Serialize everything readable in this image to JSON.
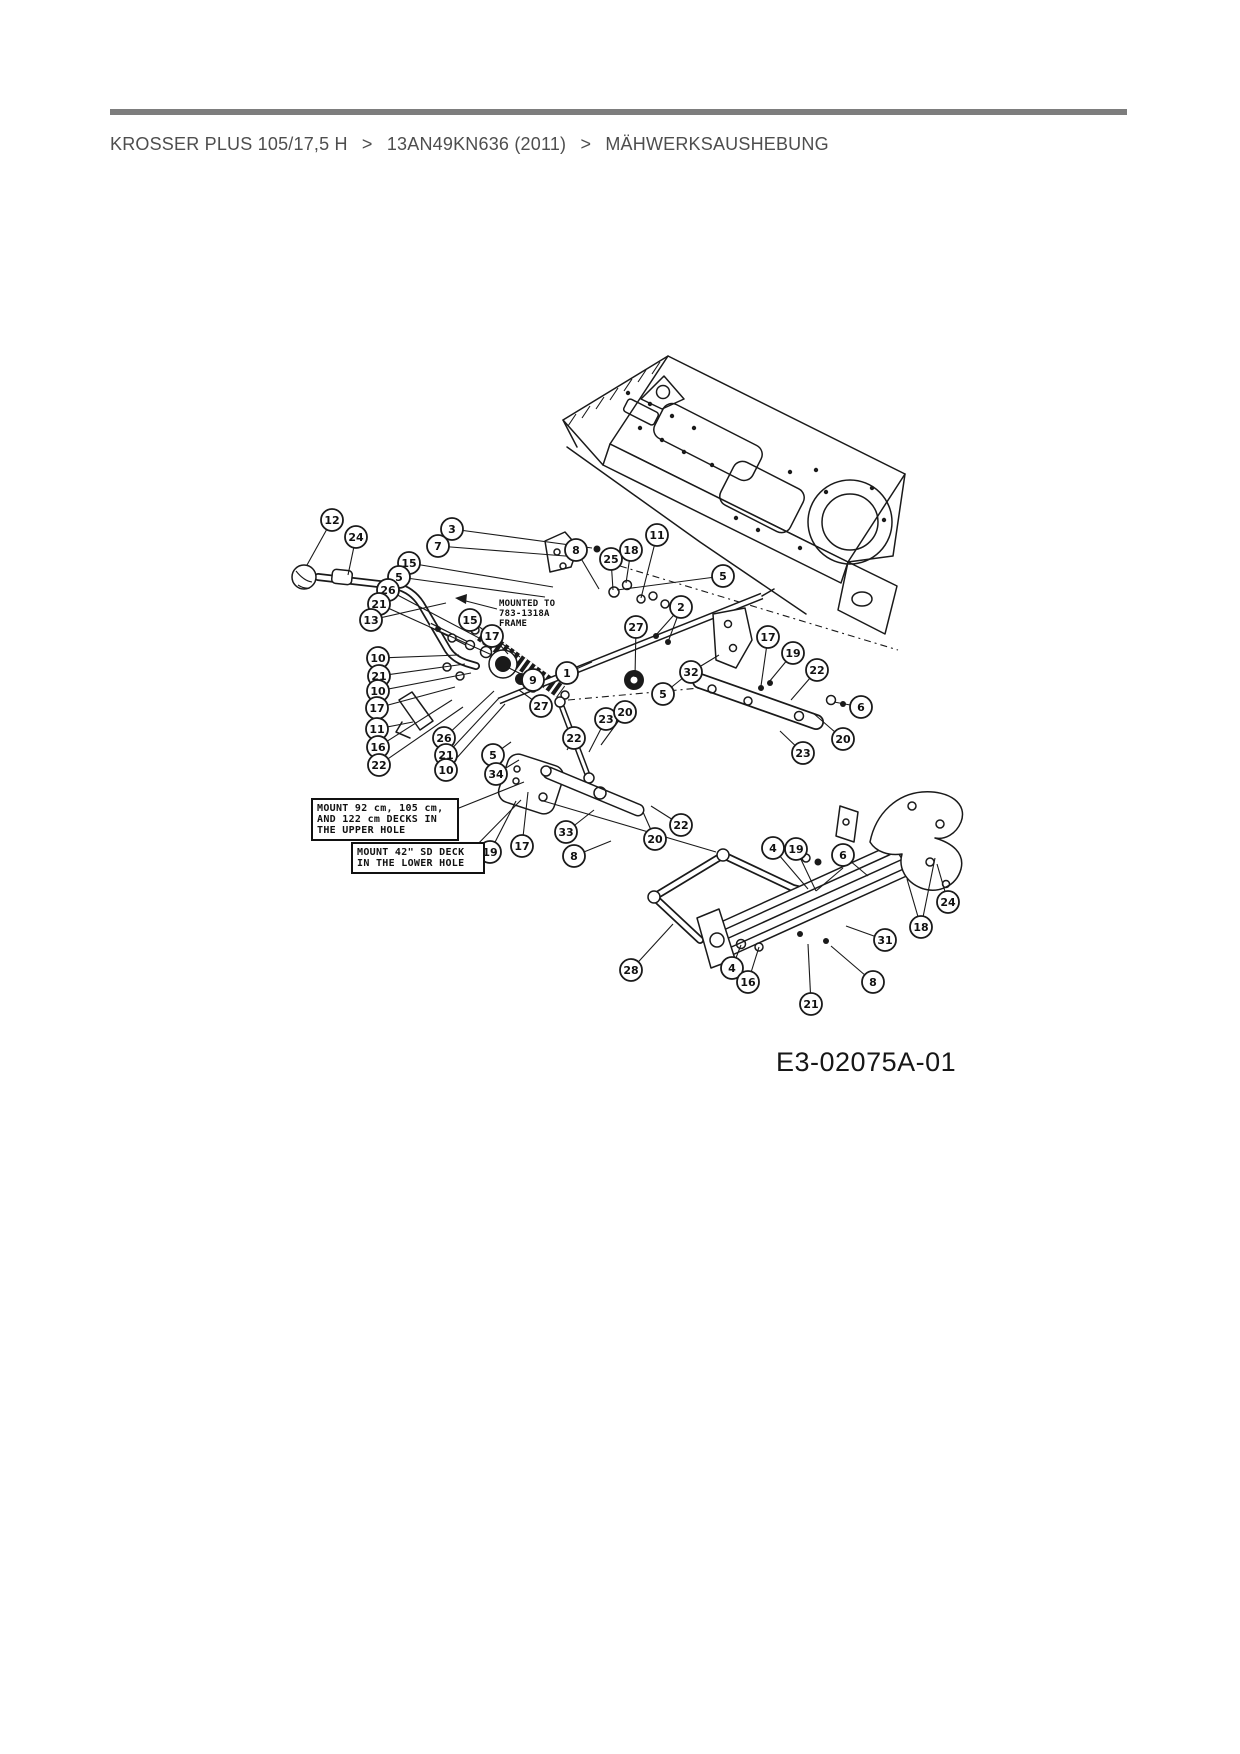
{
  "header": {
    "breadcrumb": {
      "items": [
        "KROSSER PLUS 105/17,5 H",
        "13AN49KN636 (2011)",
        "MÄHWERKSAUSHEBUNG"
      ],
      "separator": ">"
    },
    "rule_color": "#7d7d7d"
  },
  "diagram": {
    "ink_color": "#1a1a1a",
    "part_code": "E3-02075A-01",
    "notes": {
      "mounted_to": "MOUNTED TO\n783-1318A\nFRAME",
      "upper_hole": "MOUNT 92 cm, 105 cm,\nAND 122 cm DECKS IN\nTHE UPPER HOLE",
      "lower_hole": "MOUNT 42\" SD DECK\nIN THE LOWER HOLE"
    },
    "balloons": [
      {
        "n": "12",
        "x": 332,
        "y": 520,
        "tx": 307,
        "ty": 565
      },
      {
        "n": "24",
        "x": 356,
        "y": 537,
        "tx": 348,
        "ty": 575
      },
      {
        "n": "3",
        "x": 452,
        "y": 529,
        "tx": 592,
        "ty": 548
      },
      {
        "n": "7",
        "x": 438,
        "y": 546,
        "tx": 578,
        "ty": 557
      },
      {
        "n": "15",
        "x": 409,
        "y": 563,
        "tx": 553,
        "ty": 587
      },
      {
        "n": "5",
        "x": 399,
        "y": 577,
        "tx": 545,
        "ty": 597
      },
      {
        "n": "26",
        "x": 388,
        "y": 590,
        "tx": 498,
        "ty": 648
      },
      {
        "n": "21",
        "x": 379,
        "y": 604,
        "tx": 492,
        "ty": 655
      },
      {
        "n": "13",
        "x": 371,
        "y": 620,
        "tx": 446,
        "ty": 603
      },
      {
        "n": "10",
        "x": 378,
        "y": 658,
        "tx": 459,
        "ty": 655
      },
      {
        "n": "21",
        "x": 379,
        "y": 676,
        "tx": 465,
        "ty": 664
      },
      {
        "n": "10",
        "x": 378,
        "y": 691,
        "tx": 471,
        "ty": 673
      },
      {
        "n": "17",
        "x": 377,
        "y": 708,
        "tx": 455,
        "ty": 687
      },
      {
        "n": "11",
        "x": 377,
        "y": 729,
        "tx": 413,
        "ty": 722
      },
      {
        "n": "16",
        "x": 378,
        "y": 747,
        "tx": 452,
        "ty": 700
      },
      {
        "n": "22",
        "x": 379,
        "y": 765,
        "tx": 463,
        "ty": 707
      },
      {
        "n": "15",
        "x": 470,
        "y": 620,
        "tx": 520,
        "ty": 657
      },
      {
        "n": "17",
        "x": 492,
        "y": 636,
        "tx": 508,
        "ty": 654
      },
      {
        "n": "9",
        "x": 533,
        "y": 680,
        "tx": 507,
        "ty": 667
      },
      {
        "n": "1",
        "x": 567,
        "y": 673,
        "tx": 592,
        "ty": 662
      },
      {
        "n": "27",
        "x": 541,
        "y": 706,
        "tx": 519,
        "ty": 690
      },
      {
        "n": "26",
        "x": 444,
        "y": 738,
        "tx": 494,
        "ty": 691
      },
      {
        "n": "21",
        "x": 446,
        "y": 755,
        "tx": 499,
        "ty": 698
      },
      {
        "n": "10",
        "x": 446,
        "y": 770,
        "tx": 505,
        "ty": 704
      },
      {
        "n": "5",
        "x": 493,
        "y": 755,
        "tx": 511,
        "ty": 742
      },
      {
        "n": "34",
        "x": 496,
        "y": 774,
        "tx": 519,
        "ty": 760
      },
      {
        "n": "22",
        "x": 574,
        "y": 738,
        "tx": 567,
        "ty": 750
      },
      {
        "n": "23",
        "x": 606,
        "y": 719,
        "tx": 589,
        "ty": 752
      },
      {
        "n": "20",
        "x": 625,
        "y": 712,
        "tx": 601,
        "ty": 745
      },
      {
        "n": "8",
        "x": 576,
        "y": 550,
        "tx": 599,
        "ty": 589
      },
      {
        "n": "25",
        "x": 611,
        "y": 559,
        "tx": 613,
        "ty": 590
      },
      {
        "n": "18",
        "x": 631,
        "y": 550,
        "tx": 626,
        "ty": 583
      },
      {
        "n": "11",
        "x": 657,
        "y": 535,
        "tx": 641,
        "ty": 598
      },
      {
        "n": "5",
        "x": 723,
        "y": 576,
        "tx": 617,
        "ty": 590
      },
      {
        "n": "2",
        "x": 681,
        "y": 607,
        "tx": 656,
        "ty": 635,
        "tx2": 668,
        "ty2": 642
      },
      {
        "n": "27",
        "x": 636,
        "y": 627,
        "tx": 635,
        "ty": 677
      },
      {
        "n": "32",
        "x": 691,
        "y": 672,
        "tx": 719,
        "ty": 655
      },
      {
        "n": "17",
        "x": 768,
        "y": 637,
        "tx": 761,
        "ty": 686
      },
      {
        "n": "19",
        "x": 793,
        "y": 653,
        "tx": 769,
        "ty": 682
      },
      {
        "n": "22",
        "x": 817,
        "y": 670,
        "tx": 791,
        "ty": 700
      },
      {
        "n": "6",
        "x": 861,
        "y": 707,
        "tx": 834,
        "ty": 702
      },
      {
        "n": "20",
        "x": 843,
        "y": 739,
        "tx": 813,
        "ty": 713
      },
      {
        "n": "23",
        "x": 803,
        "y": 753,
        "tx": 780,
        "ty": 731
      },
      {
        "n": "5",
        "x": 663,
        "y": 694,
        "tx": 689,
        "ty": 673
      },
      {
        "n": "19",
        "x": 490,
        "y": 852,
        "tx": 516,
        "ty": 801
      },
      {
        "n": "17",
        "x": 522,
        "y": 846,
        "tx": 528,
        "ty": 792
      },
      {
        "n": "33",
        "x": 566,
        "y": 832,
        "tx": 594,
        "ty": 810
      },
      {
        "n": "8",
        "x": 574,
        "y": 856,
        "tx": 611,
        "ty": 841
      },
      {
        "n": "22",
        "x": 681,
        "y": 825,
        "tx": 651,
        "ty": 806
      },
      {
        "n": "20",
        "x": 655,
        "y": 839,
        "tx": 643,
        "ty": 812
      },
      {
        "n": "4",
        "x": 773,
        "y": 848,
        "tx": 808,
        "ty": 889
      },
      {
        "n": "19",
        "x": 796,
        "y": 849,
        "tx": 816,
        "ty": 891
      },
      {
        "n": "6",
        "x": 843,
        "y": 855,
        "tx": 868,
        "ty": 876
      },
      {
        "n": "24",
        "x": 948,
        "y": 902,
        "tx": 937,
        "ty": 864
      },
      {
        "n": "18",
        "x": 921,
        "y": 927,
        "tx": 907,
        "ty": 879,
        "tx2": 935,
        "ty2": 858
      },
      {
        "n": "31",
        "x": 885,
        "y": 940,
        "tx": 846,
        "ty": 926
      },
      {
        "n": "28",
        "x": 631,
        "y": 970,
        "tx": 673,
        "ty": 924
      },
      {
        "n": "4",
        "x": 732,
        "y": 968,
        "tx": 741,
        "ty": 945
      },
      {
        "n": "16",
        "x": 748,
        "y": 982,
        "tx": 759,
        "ty": 947
      },
      {
        "n": "8",
        "x": 873,
        "y": 982,
        "tx": 831,
        "ty": 946
      },
      {
        "n": "21",
        "x": 811,
        "y": 1004,
        "tx": 808,
        "ty": 944
      }
    ]
  }
}
